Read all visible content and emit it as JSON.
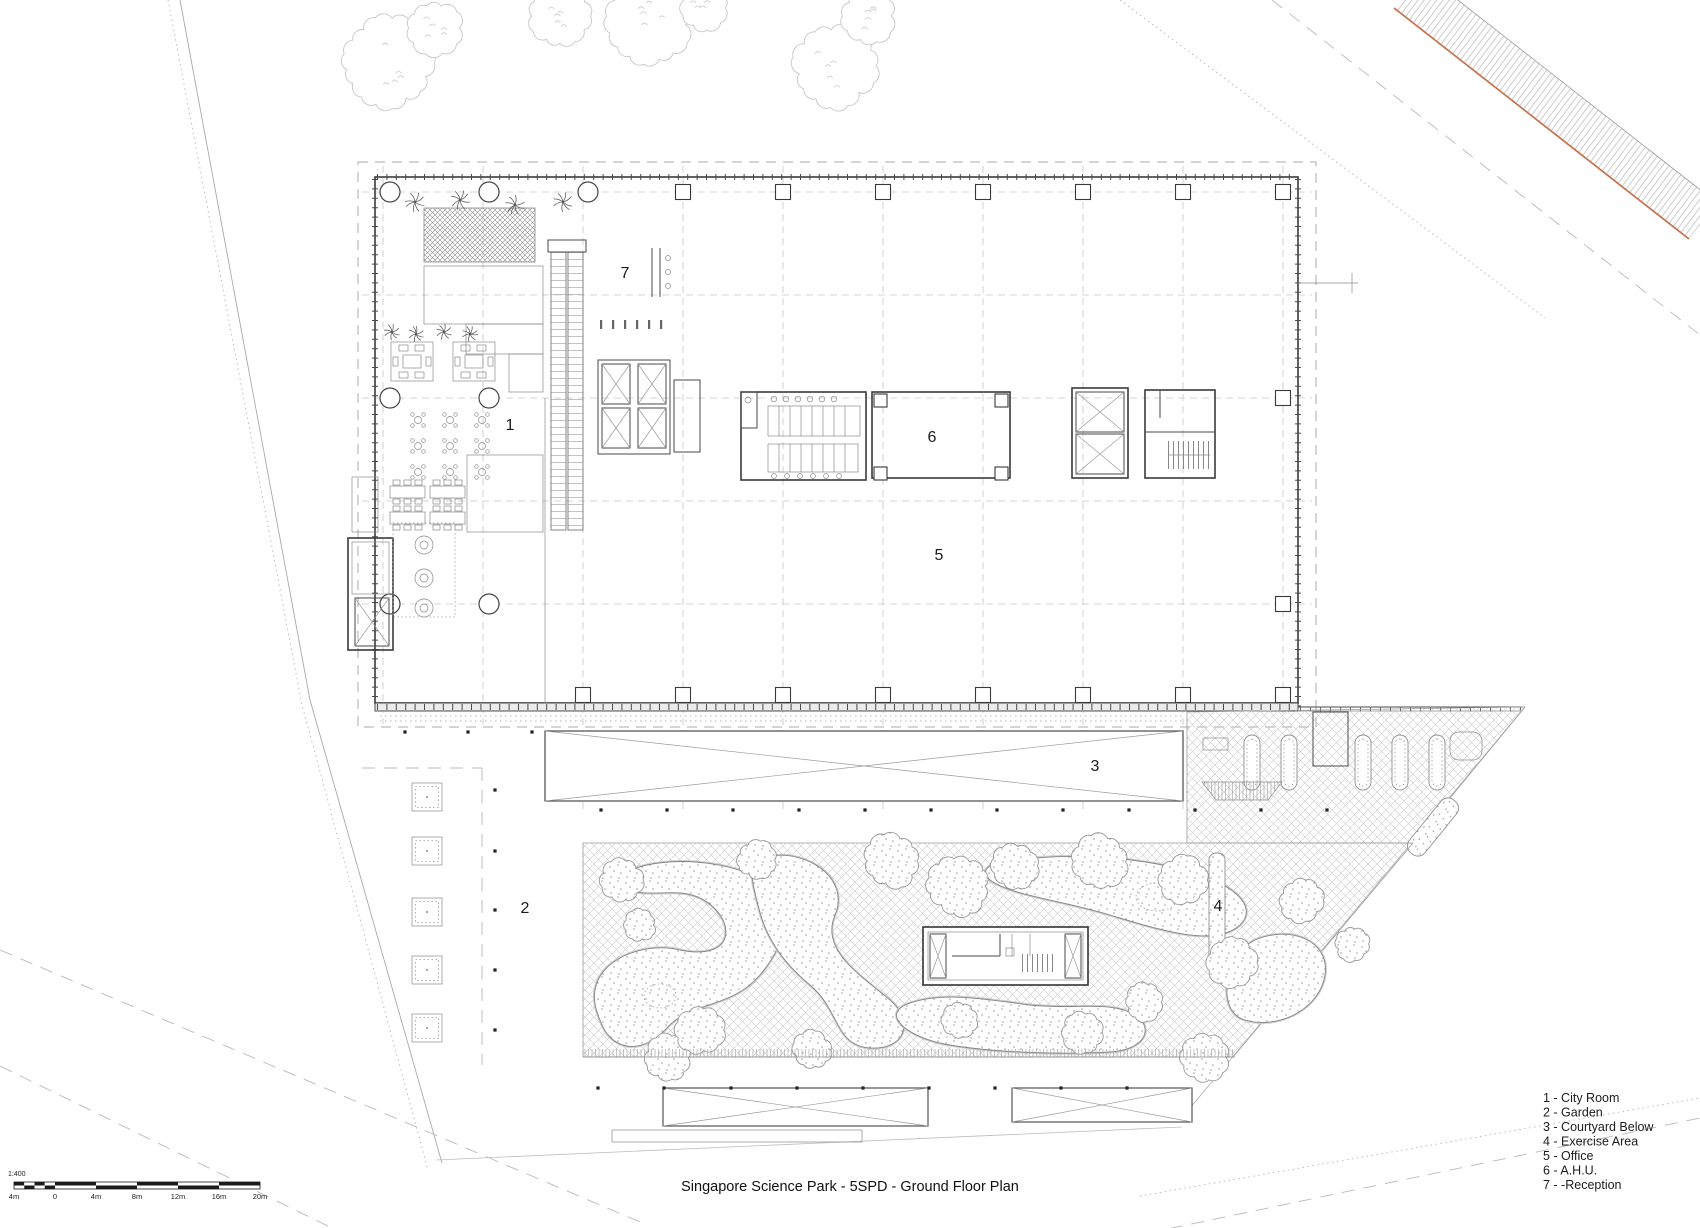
{
  "drawing": {
    "title": "Singapore Science Park - 5SPD - Ground Floor Plan",
    "scale_bar": {
      "ratio": "1:400",
      "ticks": [
        "4m",
        "0",
        "4m",
        "8m",
        "12m",
        "16m",
        "20m"
      ]
    },
    "legend": {
      "items": [
        "1 - City Room",
        "2 - Garden",
        "3 - Courtyard Below",
        "4 - Exercise Area",
        "5 - Office",
        "6 - A.H.U.",
        "7 - -Reception"
      ]
    },
    "plan_labels": [
      {
        "area": "city-room",
        "text": "1"
      },
      {
        "area": "garden",
        "text": "2"
      },
      {
        "area": "courtyard-below",
        "text": "3"
      },
      {
        "area": "exercise-area",
        "text": "4"
      },
      {
        "area": "office",
        "text": "5"
      },
      {
        "area": "ahu",
        "text": "6"
      },
      {
        "area": "reception",
        "text": "7"
      }
    ],
    "colors": {
      "road_accent": "#c4714d",
      "wall_line": "#3a3a3a",
      "light_line": "#bdbdbd"
    }
  }
}
